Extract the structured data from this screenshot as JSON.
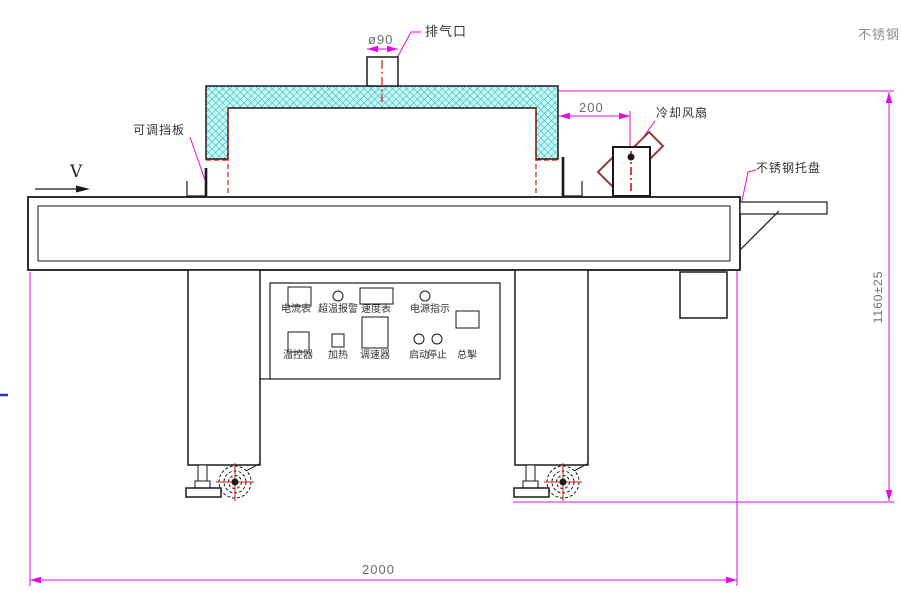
{
  "drawing": {
    "corner_note": "不锈钢",
    "direction_label": "V",
    "labels": {
      "exhaust_port": "排气口",
      "exhaust_diameter": "ø90",
      "adjustable_baffle": "可调挡板",
      "cooling_fan": "冷却风扇",
      "stainless_tray": "不锈钢托盘"
    },
    "dimensions": {
      "fan_offset": "200",
      "overall_length": "2000",
      "overall_height": "1160±25"
    },
    "colors": {
      "line": "#1a1a1a",
      "dimension": "#e608e6",
      "centerline_red": "#e01010",
      "fan_blade": "#9a3a32",
      "hatch_fill": "#c9f6f6",
      "hatch_line": "#18b6b6",
      "dim_text": "#6e6e6e",
      "note_gray": "#8f8f8f",
      "blue_mark": "#2233cc"
    },
    "panel": {
      "row1": [
        {
          "label": "电流表",
          "control": "square-meter"
        },
        {
          "label": "超温报警",
          "control": "indicator-light"
        },
        {
          "label": "速度表",
          "control": "wide-meter"
        },
        {
          "label": "电源指示",
          "control": "indicator-light"
        }
      ],
      "row2": [
        {
          "label": "温控器",
          "control": "square-meter"
        },
        {
          "label": "加热",
          "control": "small-switch"
        },
        {
          "label": "调速器",
          "control": "tall-knob"
        },
        {
          "label": "启动",
          "control": "push-button"
        },
        {
          "label": "停止",
          "control": "push-button"
        },
        {
          "label": "总掣",
          "control": "main-switch"
        }
      ]
    }
  }
}
